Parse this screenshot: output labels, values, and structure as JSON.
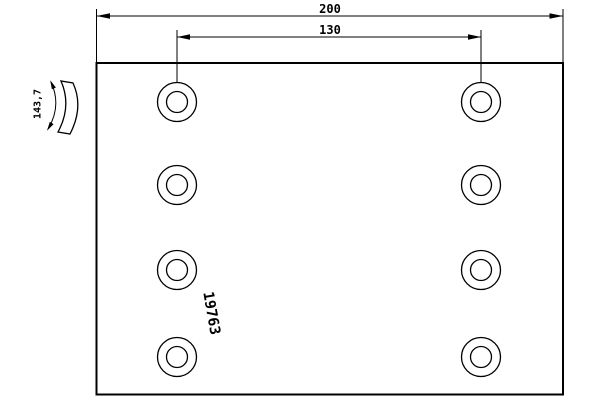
{
  "drawing": {
    "part_number": "19763",
    "dimensions": {
      "overall_length": "200",
      "hole_spacing": "130",
      "arc_radius": "143,7"
    }
  },
  "colors": {
    "line": "#000000",
    "background": "#ffffff"
  },
  "symbols": {
    "curvature_indicator": "curved-dimension-arc-with-arrows",
    "lining_section": "crescent-arc-band"
  }
}
